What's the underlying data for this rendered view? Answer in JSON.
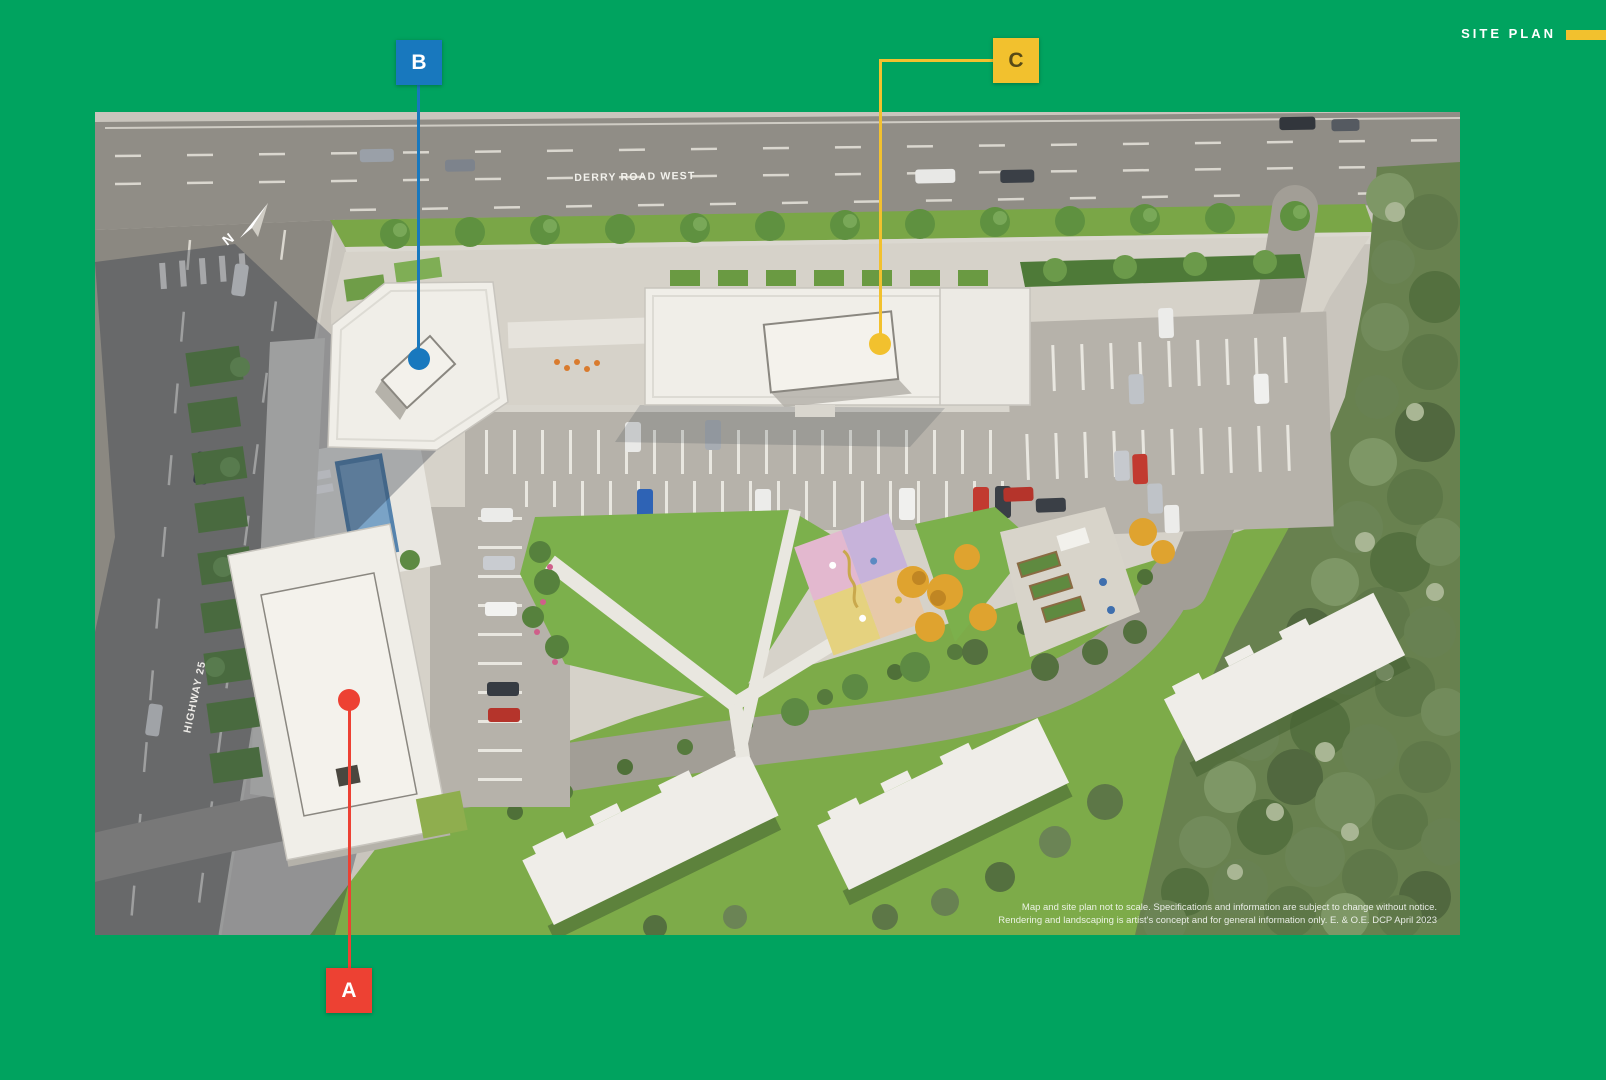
{
  "header": {
    "title": "SITE PLAN"
  },
  "markers": {
    "a": {
      "label": "A"
    },
    "b": {
      "label": "B"
    },
    "c": {
      "label": "C"
    }
  },
  "map": {
    "road_label_top": "DERRY ROAD WEST",
    "road_label_left": "HIGHWAY 25",
    "compass_label": "N",
    "disclaimer_line1": "Map and site plan not to scale. Specifications and information are subject to change without notice.",
    "disclaimer_line2": "Rendering and landscaping is artist's concept and for general information only. E. & O.E. DCP April 2023"
  },
  "colors": {
    "bg_green": "#00a35f",
    "accent_yellow": "#f2c12e",
    "marker_blue": "#1878be",
    "marker_red": "#ed4133"
  }
}
